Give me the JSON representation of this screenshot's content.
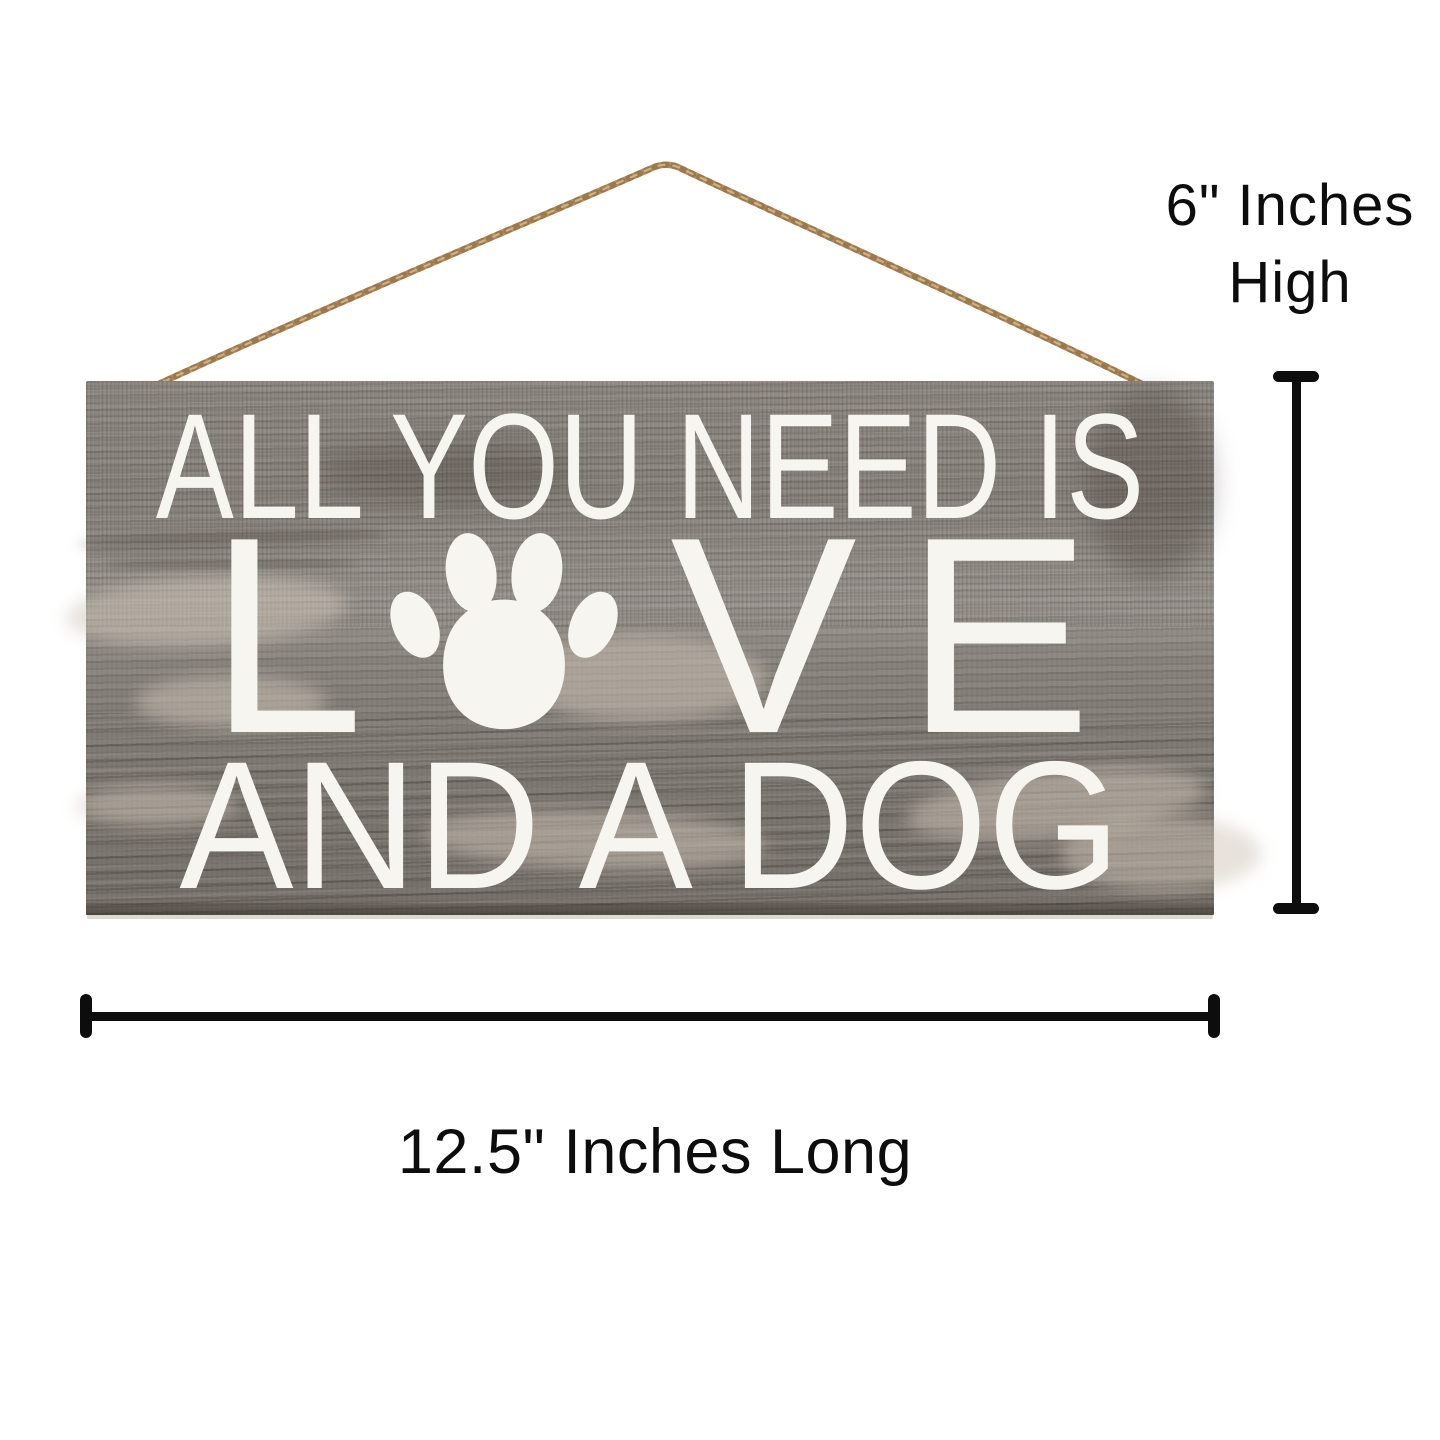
{
  "sign": {
    "line1": "ALL YOU NEED IS",
    "line2_prefix": "L",
    "line2_suffix_v": "V",
    "line2_suffix_e": "E",
    "line3": "AND A DOG",
    "icon": "paw-print-icon",
    "hanger": "twine-rope"
  },
  "labels": {
    "height_line1": "6\" Inches",
    "height_line2": "High",
    "length": "12.5\" Inches Long"
  },
  "colors": {
    "background": "#ffffff",
    "wood_base": "#8c8680",
    "wood_dark": "#6e665d",
    "wood_light": "#c2b9ac",
    "sign_text": "#f7f5f0",
    "rope": "#b58f5f",
    "measurement": "#0d0d0d"
  }
}
